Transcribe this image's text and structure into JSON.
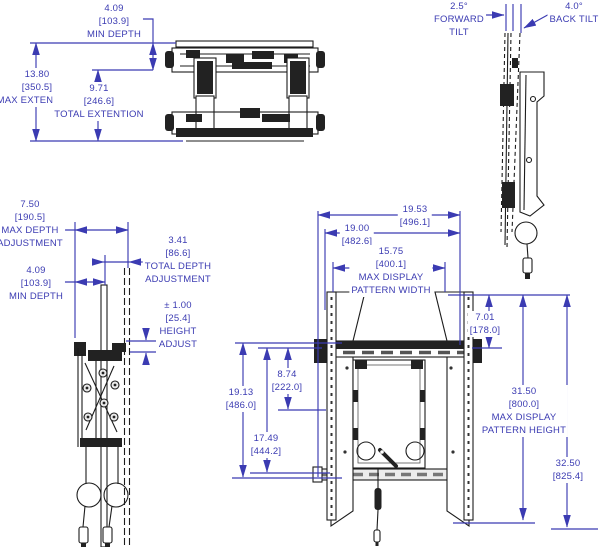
{
  "meta": {
    "background_color": "#ffffff",
    "drawing_ink_color": "#1c1c1c",
    "dimension_color": "#3b3bb2",
    "units_note_format": "inches [millimeters]"
  },
  "labels": {
    "top_min_depth": {
      "lines": [
        "4.09",
        "[103.9]",
        "MIN DEPTH"
      ]
    },
    "top_max_extension": {
      "lines": [
        "13.80",
        "[350.5]",
        "MAX EXTENSION"
      ]
    },
    "top_total_extention": {
      "lines": [
        "9.71",
        "[246.6]",
        "TOTAL EXTENTION"
      ]
    },
    "tilt_forward": {
      "lines": [
        "2.5°",
        "FORWARD",
        "TILT"
      ]
    },
    "tilt_back": {
      "lines": [
        "4.0°",
        "BACK TILT"
      ]
    },
    "side_max_depth_adjustment": {
      "lines": [
        "7.50",
        "[190.5]",
        "MAX DEPTH",
        "ADJUSTMENT"
      ]
    },
    "side_min_depth": {
      "lines": [
        "4.09",
        "[103.9]",
        "MIN DEPTH"
      ]
    },
    "side_total_depth_adjustment": {
      "lines": [
        "3.41",
        "[86.6]",
        "TOTAL DEPTH",
        "ADJUSTMENT"
      ]
    },
    "side_height_adjust": {
      "lines": [
        "± 1.00",
        "[25.4]",
        "HEIGHT",
        "ADJUST"
      ]
    },
    "front_width_overall": {
      "lines": [
        "19.53",
        "[496.1]"
      ]
    },
    "front_width_inner": {
      "lines": [
        "19.00",
        "[482.6]"
      ]
    },
    "front_max_display_pattern_width": {
      "lines": [
        "15.75",
        "[400.1]",
        "MAX DISPLAY",
        "PATTERN WIDTH"
      ]
    },
    "front_top_offset": {
      "lines": [
        "7.01",
        "[178.0]"
      ]
    },
    "front_height_19_13": {
      "lines": [
        "19.13",
        "[486.0]"
      ]
    },
    "front_height_8_74": {
      "lines": [
        "8.74",
        "[222.0]"
      ]
    },
    "front_height_17_49": {
      "lines": [
        "17.49",
        "[444.2]"
      ]
    },
    "front_max_display_pattern_height": {
      "lines": [
        "31.50",
        "[800.0]",
        "MAX DISPLAY",
        "PATTERN HEIGHT"
      ]
    },
    "front_height_overall": {
      "lines": [
        "32.50",
        "[825.4]"
      ]
    }
  }
}
